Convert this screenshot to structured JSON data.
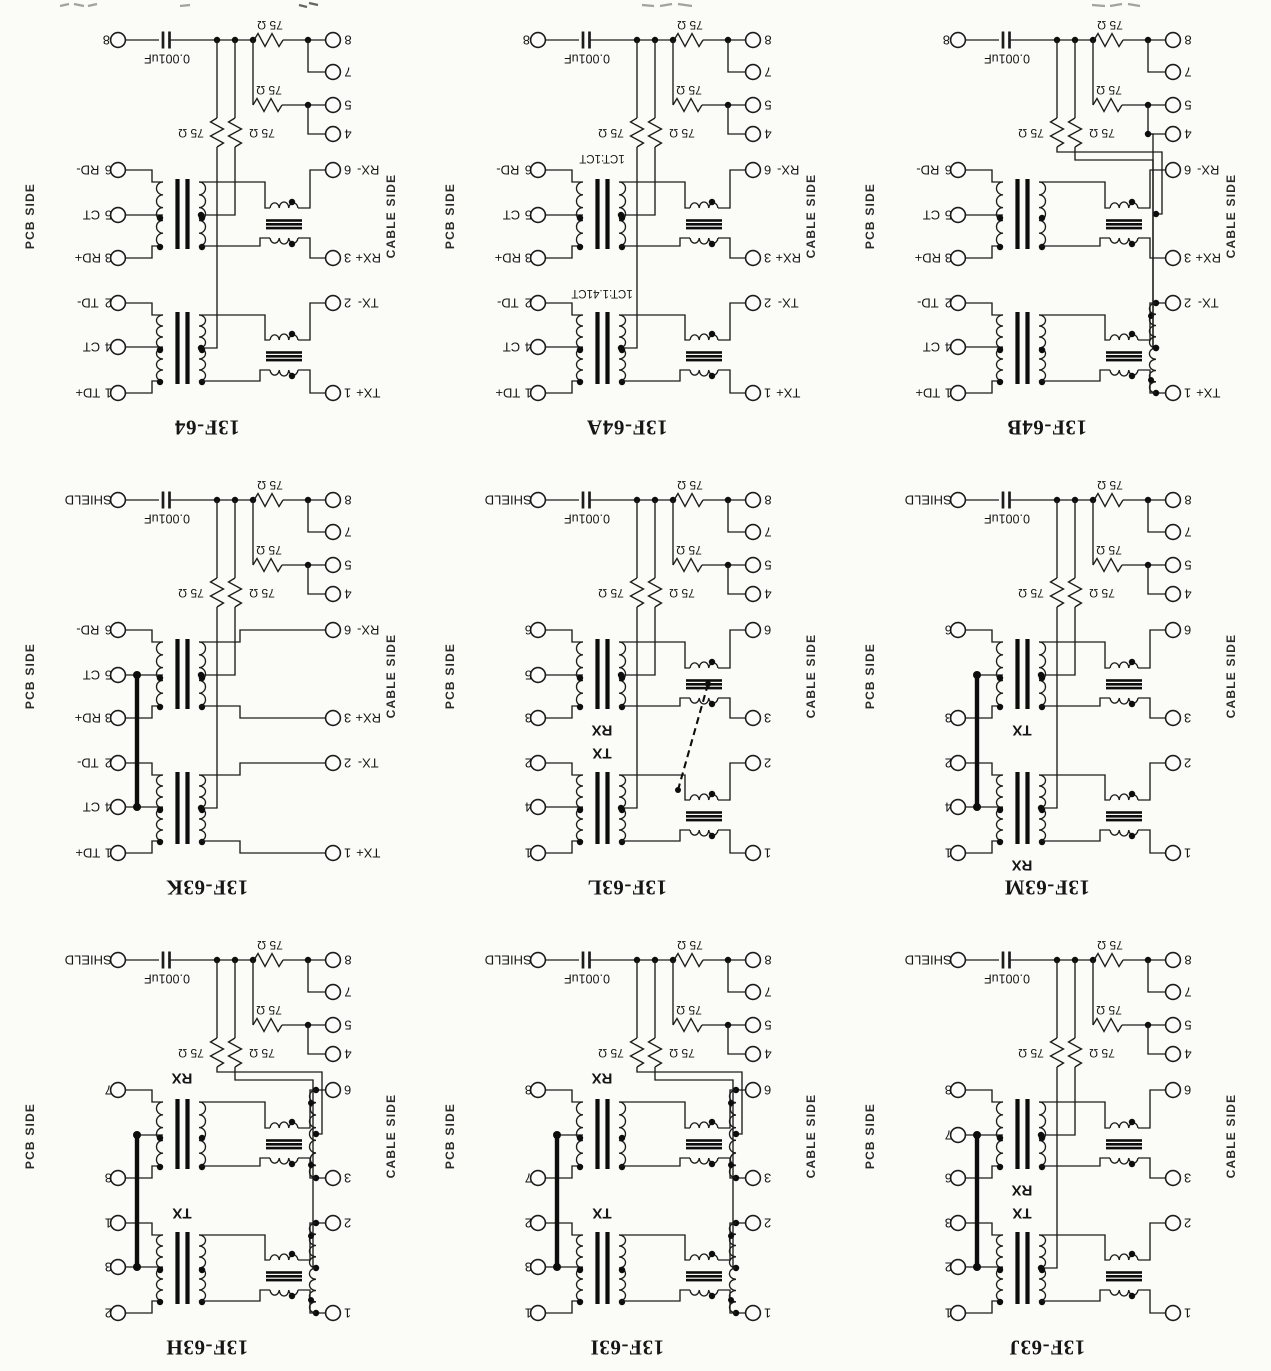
{
  "page": {
    "background": "#fbfbf8",
    "ink": "#1c1c1c"
  },
  "shared": {
    "cap_value": "0.001uF",
    "resistor_value": "75 Ω",
    "pcb_side": "PCB SIDE",
    "cable_side": "CABLE SIDE",
    "aux_cable_pins": [
      "8",
      "7",
      "5",
      "4"
    ]
  },
  "diagrams": [
    {
      "title": "13F-64",
      "corner_pin": "8",
      "pcb_pins": [
        {
          "name": "RD-",
          "pin": "6",
          "slot": 0
        },
        {
          "name": "CT",
          "pin": "5",
          "slot": 1
        },
        {
          "name": "RD+",
          "pin": "3",
          "slot": 2
        },
        {
          "name": "TD-",
          "pin": "2",
          "slot": 3
        },
        {
          "name": "CT",
          "pin": "4",
          "slot": 4
        },
        {
          "name": "TD+",
          "pin": "1",
          "slot": 5
        }
      ],
      "cable_pins": [
        {
          "pin": "6",
          "name": "RX-",
          "slot": 0
        },
        {
          "pin": "3",
          "name": "RX+",
          "slot": 2
        },
        {
          "pin": "2",
          "name": "TX-",
          "slot": 3
        },
        {
          "pin": "1",
          "name": "TX+",
          "slot": 5
        }
      ],
      "winding_labels": [],
      "structure": {
        "chokes": true,
        "auto_rx": false,
        "auto_tx": false,
        "dashed_link": false,
        "bold_ct_link": false,
        "ct_pad_top": true,
        "ct_pad_bottom": true
      }
    },
    {
      "title": "13F-64A",
      "corner_pin": "8",
      "pcb_pins": [
        {
          "name": "RD-",
          "pin": "6",
          "slot": 0
        },
        {
          "name": "CT",
          "pin": "5",
          "slot": 1
        },
        {
          "name": "RD+",
          "pin": "3",
          "slot": 2
        },
        {
          "name": "TD-",
          "pin": "2",
          "slot": 3
        },
        {
          "name": "CT",
          "pin": "4",
          "slot": 4
        },
        {
          "name": "TD+",
          "pin": "1",
          "slot": 5
        }
      ],
      "cable_pins": [
        {
          "pin": "6",
          "name": "RX-",
          "slot": 0
        },
        {
          "pin": "3",
          "name": "RX+",
          "slot": 2
        },
        {
          "pin": "2",
          "name": "TX-",
          "slot": 3
        },
        {
          "pin": "1",
          "name": "TX+",
          "slot": 5
        }
      ],
      "winding_labels": [
        {
          "text": "1CT:1CT",
          "pos": "above_top",
          "kind": "ratio"
        },
        {
          "text": "1CT:1.41CT",
          "pos": "above_bottom",
          "kind": "ratio"
        }
      ],
      "structure": {
        "chokes": true,
        "auto_rx": false,
        "auto_tx": false,
        "dashed_link": false,
        "bold_ct_link": false,
        "ct_pad_top": true,
        "ct_pad_bottom": true
      }
    },
    {
      "title": "13F-64B",
      "corner_pin": "8",
      "pcb_pins": [
        {
          "name": "RD-",
          "pin": "6",
          "slot": 0
        },
        {
          "name": "CT",
          "pin": "5",
          "slot": 1
        },
        {
          "name": "RD+",
          "pin": "3",
          "slot": 2
        },
        {
          "name": "TD-",
          "pin": "2",
          "slot": 3
        },
        {
          "name": "CT",
          "pin": "4",
          "slot": 4
        },
        {
          "name": "TD+",
          "pin": "1",
          "slot": 5
        }
      ],
      "cable_pins": [
        {
          "pin": "6",
          "name": "RX-",
          "slot": 0
        },
        {
          "pin": "3",
          "name": "RX+",
          "slot": 2
        },
        {
          "pin": "2",
          "name": "TX-",
          "slot": 3
        },
        {
          "pin": "1",
          "name": "TX+",
          "slot": 5
        }
      ],
      "winding_labels": [],
      "structure": {
        "chokes": true,
        "auto_rx": false,
        "auto_tx": true,
        "dashed_link": false,
        "bold_ct_link": false,
        "ct_pad_top": true,
        "ct_pad_bottom": true
      }
    },
    {
      "title": "13F-63K",
      "corner_pin": "SHIELD",
      "pcb_pins": [
        {
          "name": "RD-",
          "pin": "6",
          "slot": 0
        },
        {
          "name": "CT",
          "pin": "5",
          "slot": 1
        },
        {
          "name": "RD+",
          "pin": "3",
          "slot": 2
        },
        {
          "name": "TD-",
          "pin": "2",
          "slot": 3
        },
        {
          "name": "CT",
          "pin": "4",
          "slot": 4
        },
        {
          "name": "TD+",
          "pin": "1",
          "slot": 5
        }
      ],
      "cable_pins": [
        {
          "pin": "6",
          "name": "RX-",
          "slot": 0
        },
        {
          "pin": "3",
          "name": "RX+",
          "slot": 2
        },
        {
          "pin": "2",
          "name": "TX-",
          "slot": 3
        },
        {
          "pin": "1",
          "name": "TX+",
          "slot": 5
        }
      ],
      "winding_labels": [],
      "structure": {
        "chokes": false,
        "auto_rx": false,
        "auto_tx": false,
        "dashed_link": false,
        "bold_ct_link": true,
        "ct_pad_top": true,
        "ct_pad_bottom": true
      }
    },
    {
      "title": "13F-63L",
      "corner_pin": "SHIELD",
      "pcb_pins": [
        {
          "name": "",
          "pin": "6",
          "slot": 0
        },
        {
          "name": "",
          "pin": "5",
          "slot": 1
        },
        {
          "name": "",
          "pin": "3",
          "slot": 2
        },
        {
          "name": "",
          "pin": "2",
          "slot": 3
        },
        {
          "name": "",
          "pin": "4",
          "slot": 4
        },
        {
          "name": "",
          "pin": "1",
          "slot": 5
        }
      ],
      "cable_pins": [
        {
          "pin": "6",
          "name": "",
          "slot": 0
        },
        {
          "pin": "3",
          "name": "",
          "slot": 2
        },
        {
          "pin": "2",
          "name": "",
          "slot": 3
        },
        {
          "pin": "1",
          "name": "",
          "slot": 5
        }
      ],
      "winding_labels": [
        {
          "text": "RX",
          "pos": "below_top",
          "kind": "name"
        },
        {
          "text": "TX",
          "pos": "above_bottom",
          "kind": "name"
        }
      ],
      "structure": {
        "chokes": true,
        "auto_rx": false,
        "auto_tx": false,
        "dashed_link": true,
        "bold_ct_link": false,
        "ct_pad_top": true,
        "ct_pad_bottom": true
      }
    },
    {
      "title": "13F-63M",
      "corner_pin": "SHIELD",
      "pcb_pins": [
        {
          "name": "",
          "pin": "6",
          "slot": 0
        },
        {
          "name": "",
          "pin": "3",
          "slot": 2
        },
        {
          "name": "",
          "pin": "2",
          "slot": 3
        },
        {
          "name": "",
          "pin": "4",
          "slot": 4
        },
        {
          "name": "",
          "pin": "1",
          "slot": 5
        }
      ],
      "cable_pins": [
        {
          "pin": "6",
          "name": "",
          "slot": 0
        },
        {
          "pin": "3",
          "name": "",
          "slot": 2
        },
        {
          "pin": "2",
          "name": "",
          "slot": 3
        },
        {
          "pin": "1",
          "name": "",
          "slot": 5
        }
      ],
      "winding_labels": [
        {
          "text": "TX",
          "pos": "below_top",
          "kind": "name"
        },
        {
          "text": "RX",
          "pos": "below_bottom",
          "kind": "name"
        }
      ],
      "structure": {
        "chokes": true,
        "auto_rx": false,
        "auto_tx": false,
        "dashed_link": false,
        "bold_ct_link": true,
        "ct_pad_top": false,
        "ct_pad_bottom": true
      }
    },
    {
      "title": "13F-63H",
      "corner_pin": "SHIELD",
      "pcb_pins": [
        {
          "name": "",
          "pin": "7",
          "slot": 0
        },
        {
          "name": "",
          "pin": "8",
          "slot": 2
        },
        {
          "name": "",
          "pin": "1",
          "slot": 3
        },
        {
          "name": "",
          "pin": "3",
          "slot": 4
        },
        {
          "name": "",
          "pin": "2",
          "slot": 5
        }
      ],
      "cable_pins": [
        {
          "pin": "6",
          "name": "",
          "slot": 0
        },
        {
          "pin": "3",
          "name": "",
          "slot": 2
        },
        {
          "pin": "2",
          "name": "",
          "slot": 3
        },
        {
          "pin": "1",
          "name": "",
          "slot": 5
        }
      ],
      "winding_labels": [
        {
          "text": "RX",
          "pos": "above_top",
          "kind": "name"
        },
        {
          "text": "TX",
          "pos": "above_bottom",
          "kind": "name"
        }
      ],
      "structure": {
        "chokes": true,
        "auto_rx": true,
        "auto_tx": true,
        "dashed_link": false,
        "bold_ct_link": true,
        "ct_pad_top": false,
        "ct_pad_bottom": true
      }
    },
    {
      "title": "13F-63I",
      "corner_pin": "SHIELD",
      "pcb_pins": [
        {
          "name": "",
          "pin": "8",
          "slot": 0
        },
        {
          "name": "",
          "pin": "7",
          "slot": 2
        },
        {
          "name": "",
          "pin": "2",
          "slot": 3
        },
        {
          "name": "",
          "pin": "3",
          "slot": 4
        },
        {
          "name": "",
          "pin": "1",
          "slot": 5
        }
      ],
      "cable_pins": [
        {
          "pin": "6",
          "name": "",
          "slot": 0
        },
        {
          "pin": "3",
          "name": "",
          "slot": 2
        },
        {
          "pin": "2",
          "name": "",
          "slot": 3
        },
        {
          "pin": "1",
          "name": "",
          "slot": 5
        }
      ],
      "winding_labels": [
        {
          "text": "RX",
          "pos": "above_top",
          "kind": "name"
        },
        {
          "text": "TX",
          "pos": "above_bottom",
          "kind": "name"
        }
      ],
      "structure": {
        "chokes": true,
        "auto_rx": true,
        "auto_tx": true,
        "dashed_link": false,
        "bold_ct_link": true,
        "ct_pad_top": false,
        "ct_pad_bottom": true
      }
    },
    {
      "title": "13F-63J",
      "corner_pin": "SHIELD",
      "pcb_pins": [
        {
          "name": "",
          "pin": "8",
          "slot": 0
        },
        {
          "name": "",
          "pin": "7",
          "slot": 1
        },
        {
          "name": "",
          "pin": "6",
          "slot": 2
        },
        {
          "name": "",
          "pin": "3",
          "slot": 3
        },
        {
          "name": "",
          "pin": "2",
          "slot": 4
        },
        {
          "name": "",
          "pin": "1",
          "slot": 5
        }
      ],
      "cable_pins": [
        {
          "pin": "6",
          "name": "",
          "slot": 0
        },
        {
          "pin": "3",
          "name": "",
          "slot": 2
        },
        {
          "pin": "2",
          "name": "",
          "slot": 3
        },
        {
          "pin": "1",
          "name": "",
          "slot": 5
        }
      ],
      "winding_labels": [
        {
          "text": "RX",
          "pos": "below_top",
          "kind": "name"
        },
        {
          "text": "TX",
          "pos": "above_bottom",
          "kind": "name"
        }
      ],
      "structure": {
        "chokes": true,
        "auto_rx": false,
        "auto_tx": false,
        "dashed_link": false,
        "bold_ct_link": true,
        "ct_pad_top": true,
        "ct_pad_bottom": true
      }
    }
  ]
}
